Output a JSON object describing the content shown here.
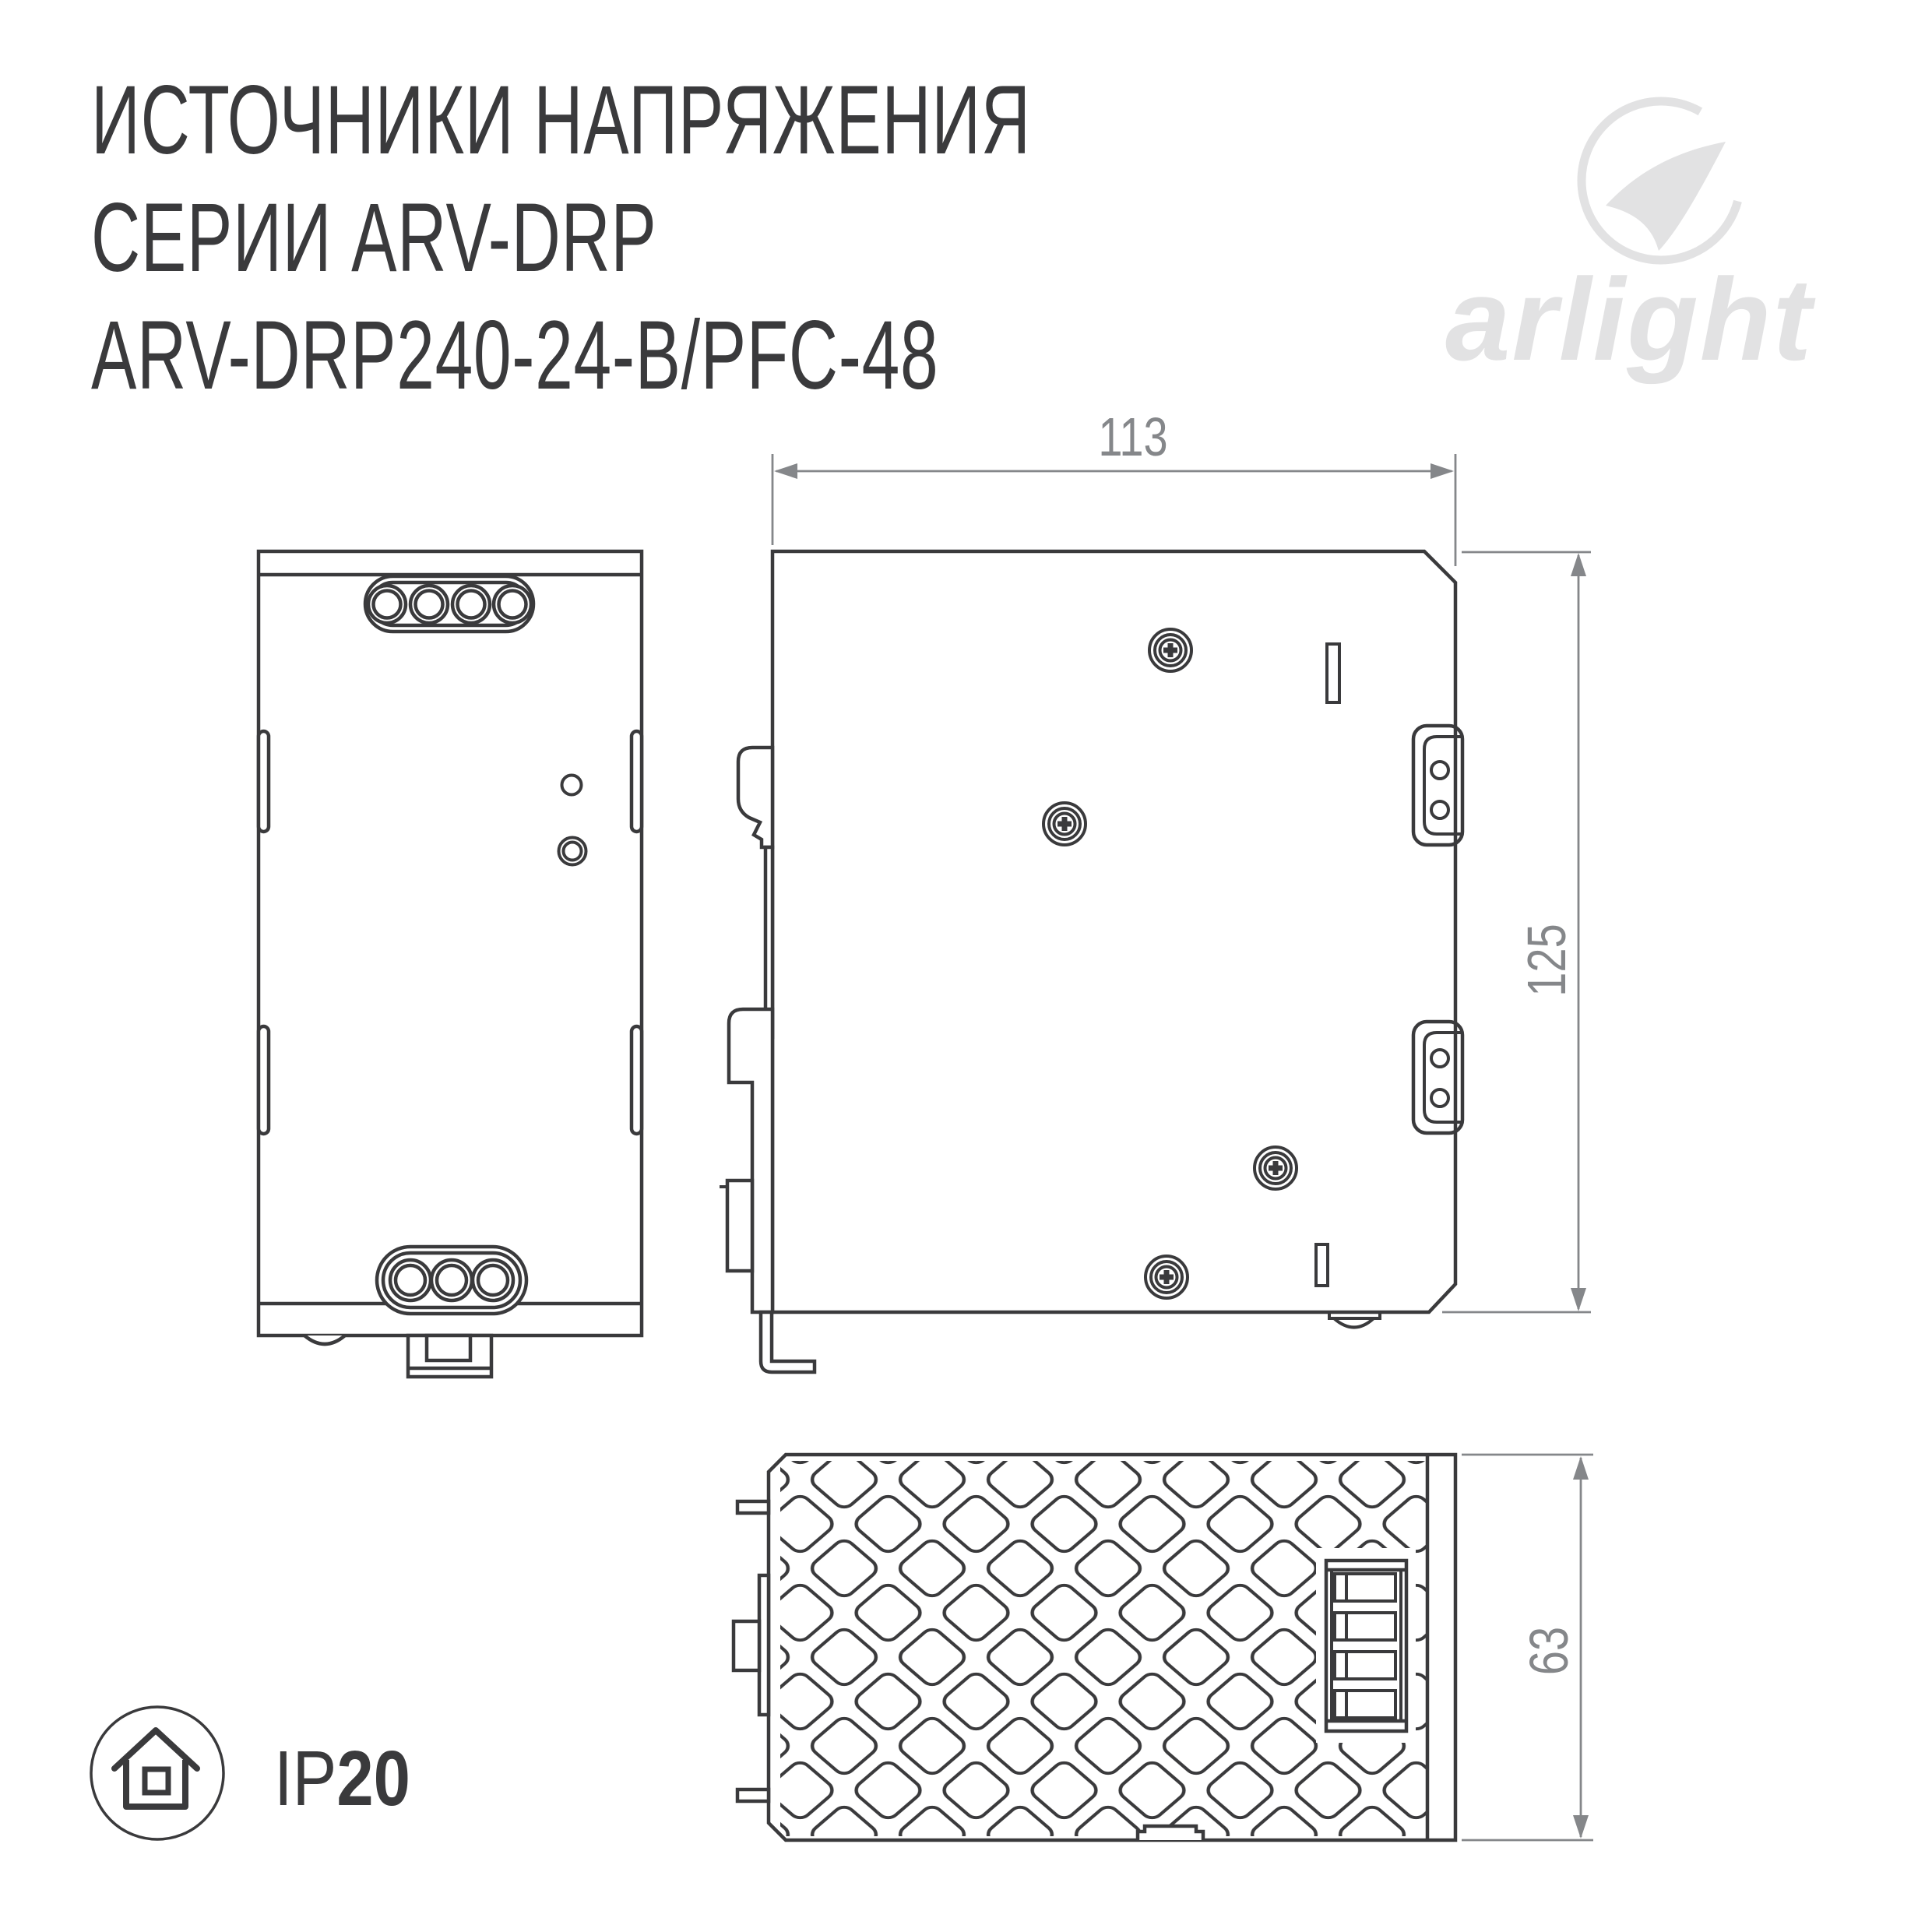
{
  "header": {
    "title_lines": [
      "ИСТОЧНИКИ НАПРЯЖЕНИЯ",
      "СЕРИИ ARV-DRP",
      "ARV-DRP240-24-B/PFC-48"
    ]
  },
  "logo": {
    "brand": "arlight"
  },
  "drawing": {
    "views": {
      "front": "front-view",
      "side": "side-view",
      "bottom": "bottom-view"
    },
    "dimensions": {
      "width_mm": "113",
      "height_mm": "125",
      "depth_mm": "63"
    }
  },
  "footer": {
    "ip_prefix": "IP",
    "ip_value": "20",
    "ip_label": "IP20"
  },
  "colors": {
    "line": "#3a3a3c",
    "dimension": "#85878a",
    "logo": "#e2e2e3",
    "background": "#ffffff"
  }
}
